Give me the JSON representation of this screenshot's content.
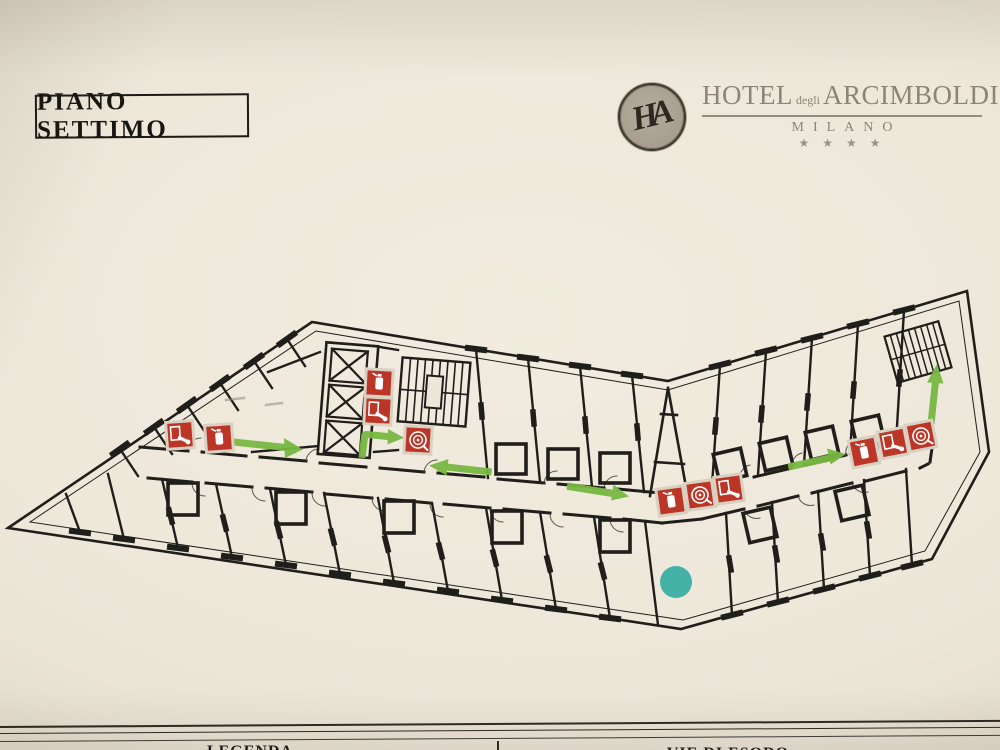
{
  "title": {
    "label": "PIANO SETTIMO"
  },
  "logo": {
    "monogram": "HA",
    "word_hotel": "HOTEL",
    "word_degli": "degli",
    "word_name": "ARCIMBOLDI",
    "city": "MILANO",
    "stars": "★ ★ ★ ★"
  },
  "legend": {
    "left_header": "LEGENDA",
    "right_header": "VIE DI ESODO"
  },
  "colors": {
    "safety_red": "#bc3627",
    "route_green": "#79b843",
    "you_are_here_teal": "#36aca0",
    "paper": "#ede7da",
    "ink": "#201e1a",
    "logo_gray": "#8d8477"
  },
  "plan": {
    "floor_name": "PIANO SETTIMO",
    "safety_icons": [
      {
        "id": "hydrant-left-wing",
        "type": "fire-hose-hydrant"
      },
      {
        "id": "extinguisher-left-wing",
        "type": "fire-extinguisher"
      },
      {
        "id": "extinguisher-core",
        "type": "fire-extinguisher"
      },
      {
        "id": "hydrant-core",
        "type": "fire-hose-hydrant"
      },
      {
        "id": "hose-reel-core",
        "type": "hose-reel-naspo"
      },
      {
        "id": "extinguisher-bend",
        "type": "fire-extinguisher"
      },
      {
        "id": "hose-reel-bend",
        "type": "hose-reel-naspo"
      },
      {
        "id": "hydrant-bend",
        "type": "fire-hose-hydrant"
      },
      {
        "id": "extinguisher-right-wing",
        "type": "fire-extinguisher"
      },
      {
        "id": "hydrant-right-wing",
        "type": "fire-hose-hydrant"
      },
      {
        "id": "hose-reel-right-wing",
        "type": "hose-reel-naspo"
      }
    ],
    "escape_arrows": [
      {
        "direction": "right",
        "location": "left-wing-corridor"
      },
      {
        "direction": "elbow-up-right",
        "location": "core-stairwell"
      },
      {
        "direction": "left",
        "location": "mid-corridor"
      },
      {
        "direction": "right",
        "location": "mid-corridor-east"
      },
      {
        "direction": "right",
        "location": "right-wing-corridor"
      },
      {
        "direction": "up",
        "location": "right-stairwell"
      }
    ],
    "you_are_here_marker": "teal-dot"
  }
}
